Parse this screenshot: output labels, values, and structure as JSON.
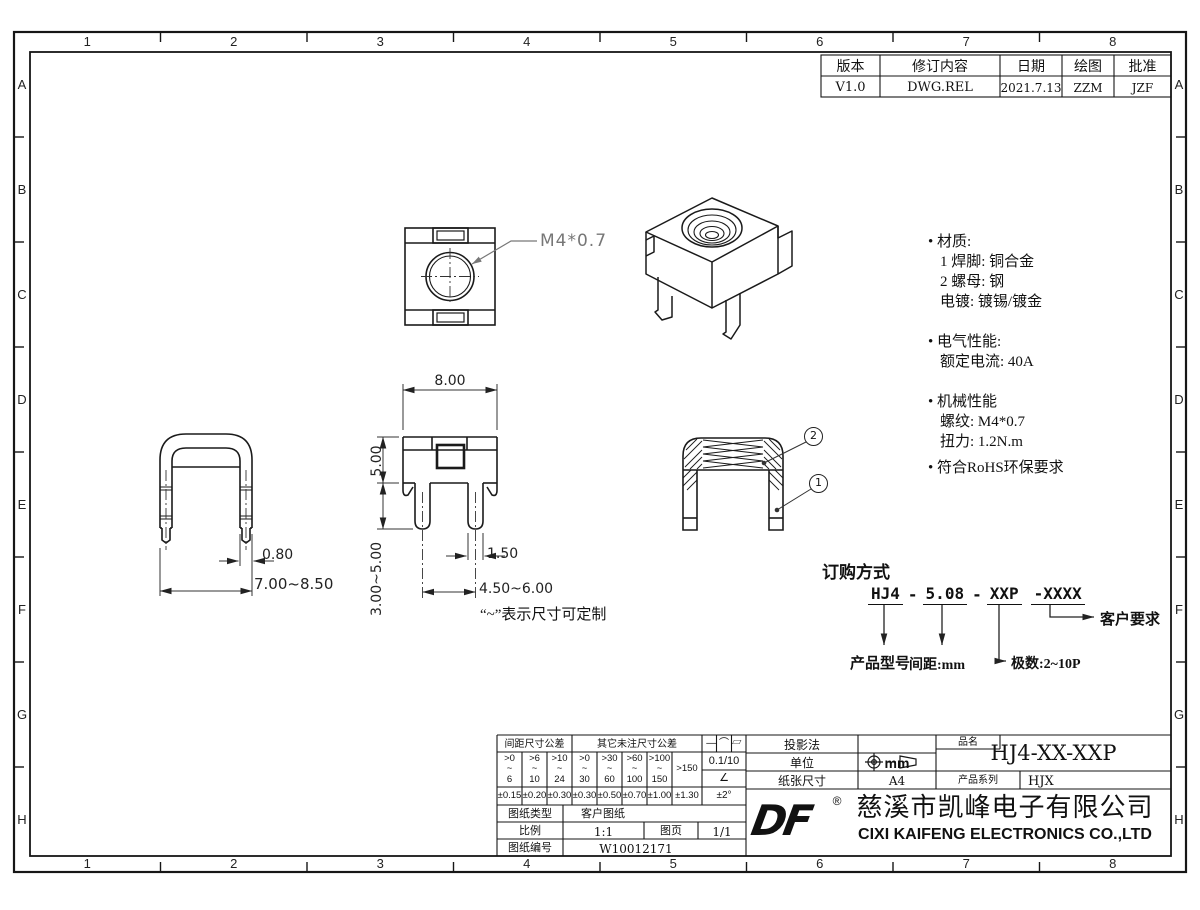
{
  "sheet": {
    "zones_h": [
      "1",
      "2",
      "3",
      "4",
      "5",
      "6",
      "7",
      "8"
    ],
    "zones_v": [
      "A",
      "B",
      "C",
      "D",
      "E",
      "F",
      "G",
      "H"
    ]
  },
  "revision": {
    "headers": [
      "版本",
      "修订内容",
      "日期",
      "绘图",
      "批准"
    ],
    "row": [
      "V1.0",
      "DWG.REL",
      "2021.7.13",
      "ZZM",
      "JZF"
    ]
  },
  "notes": {
    "material_title": "• 材质:",
    "material_1": "1 焊脚: 铜合金",
    "material_2": "2 螺母: 钢",
    "material_3": "电镀:  镀锡/镀金",
    "electrical_title": "• 电气性能:",
    "electrical_1": "额定电流: 40A",
    "mechanical_title": "• 机械性能",
    "mechanical_1": "螺纹: M4*0.7",
    "mechanical_2": "扭力: 1.2N.m",
    "rohs": "• 符合RoHS环保要求"
  },
  "dims": {
    "thread_callout": "M4*0.7",
    "front_width": "8.00",
    "front_height": "5.00",
    "front_leg": "3.00~5.00",
    "pin_width_front": "1.50",
    "pin_pitch": "4.50~6.00",
    "pin_thickness": "0.80",
    "side_width": "7.00~8.50",
    "custom_note": "“~”表示尺寸可定制",
    "balloon_1": "1",
    "balloon_2": "2"
  },
  "ordering": {
    "title": "订购方式",
    "p1": "HJ4",
    "sep1": "-",
    "p2": "5.08",
    "sep2": "-",
    "p3": "XXP",
    "p4": "-XXXX",
    "label_model": "产品型号",
    "label_pitch": "间距:mm",
    "label_poles": "极数:2~10P",
    "label_customer": "客户要求"
  },
  "titleblock": {
    "tol": {
      "pitch_header": "间距尺寸公差",
      "other_header": "其它未注尺寸公差",
      "tilde": "~",
      "ranges": [
        {
          "a": ">0",
          "b": "6"
        },
        {
          "a": ">6",
          "b": "10"
        },
        {
          "a": ">10",
          "b": "24"
        },
        {
          "a": ">0",
          "b": "30"
        },
        {
          "a": ">30",
          "b": "60"
        },
        {
          "a": ">60",
          "b": "100"
        },
        {
          "a": ">100",
          "b": "150"
        }
      ],
      "over": ">150",
      "values": [
        "±0.15",
        "±0.20",
        "±0.30",
        "±0.30",
        "±0.50",
        "±0.70",
        "±1.00",
        "±1.30"
      ],
      "geo_symbols": "— ⌒ ▱",
      "flatness": "0.1/10",
      "angle_symbol": "∠",
      "angle_value": "±2°"
    },
    "type_label": "图纸类型",
    "type_value": "客户图纸",
    "scale_label": "比例",
    "scale_value": "1:1",
    "sheet_label": "图页",
    "sheet_value": "1/1",
    "no_label": "图纸编号",
    "no_value": "W10012171",
    "projection_label": "投影法",
    "unit_label": "单位",
    "unit_value": "mm",
    "paper_label": "纸张尺寸",
    "paper_value": "A4",
    "name_label": "品名",
    "name_value": "HJ4-XX-XXP",
    "series_label": "产品系列",
    "series_value": "HJX",
    "logo_text": "DF",
    "reg_mark": "®",
    "company_cn": "慈溪市凯峰电子有限公司",
    "company_en": "CIXI KAIFENG ELECTRONICS CO.,LTD"
  }
}
